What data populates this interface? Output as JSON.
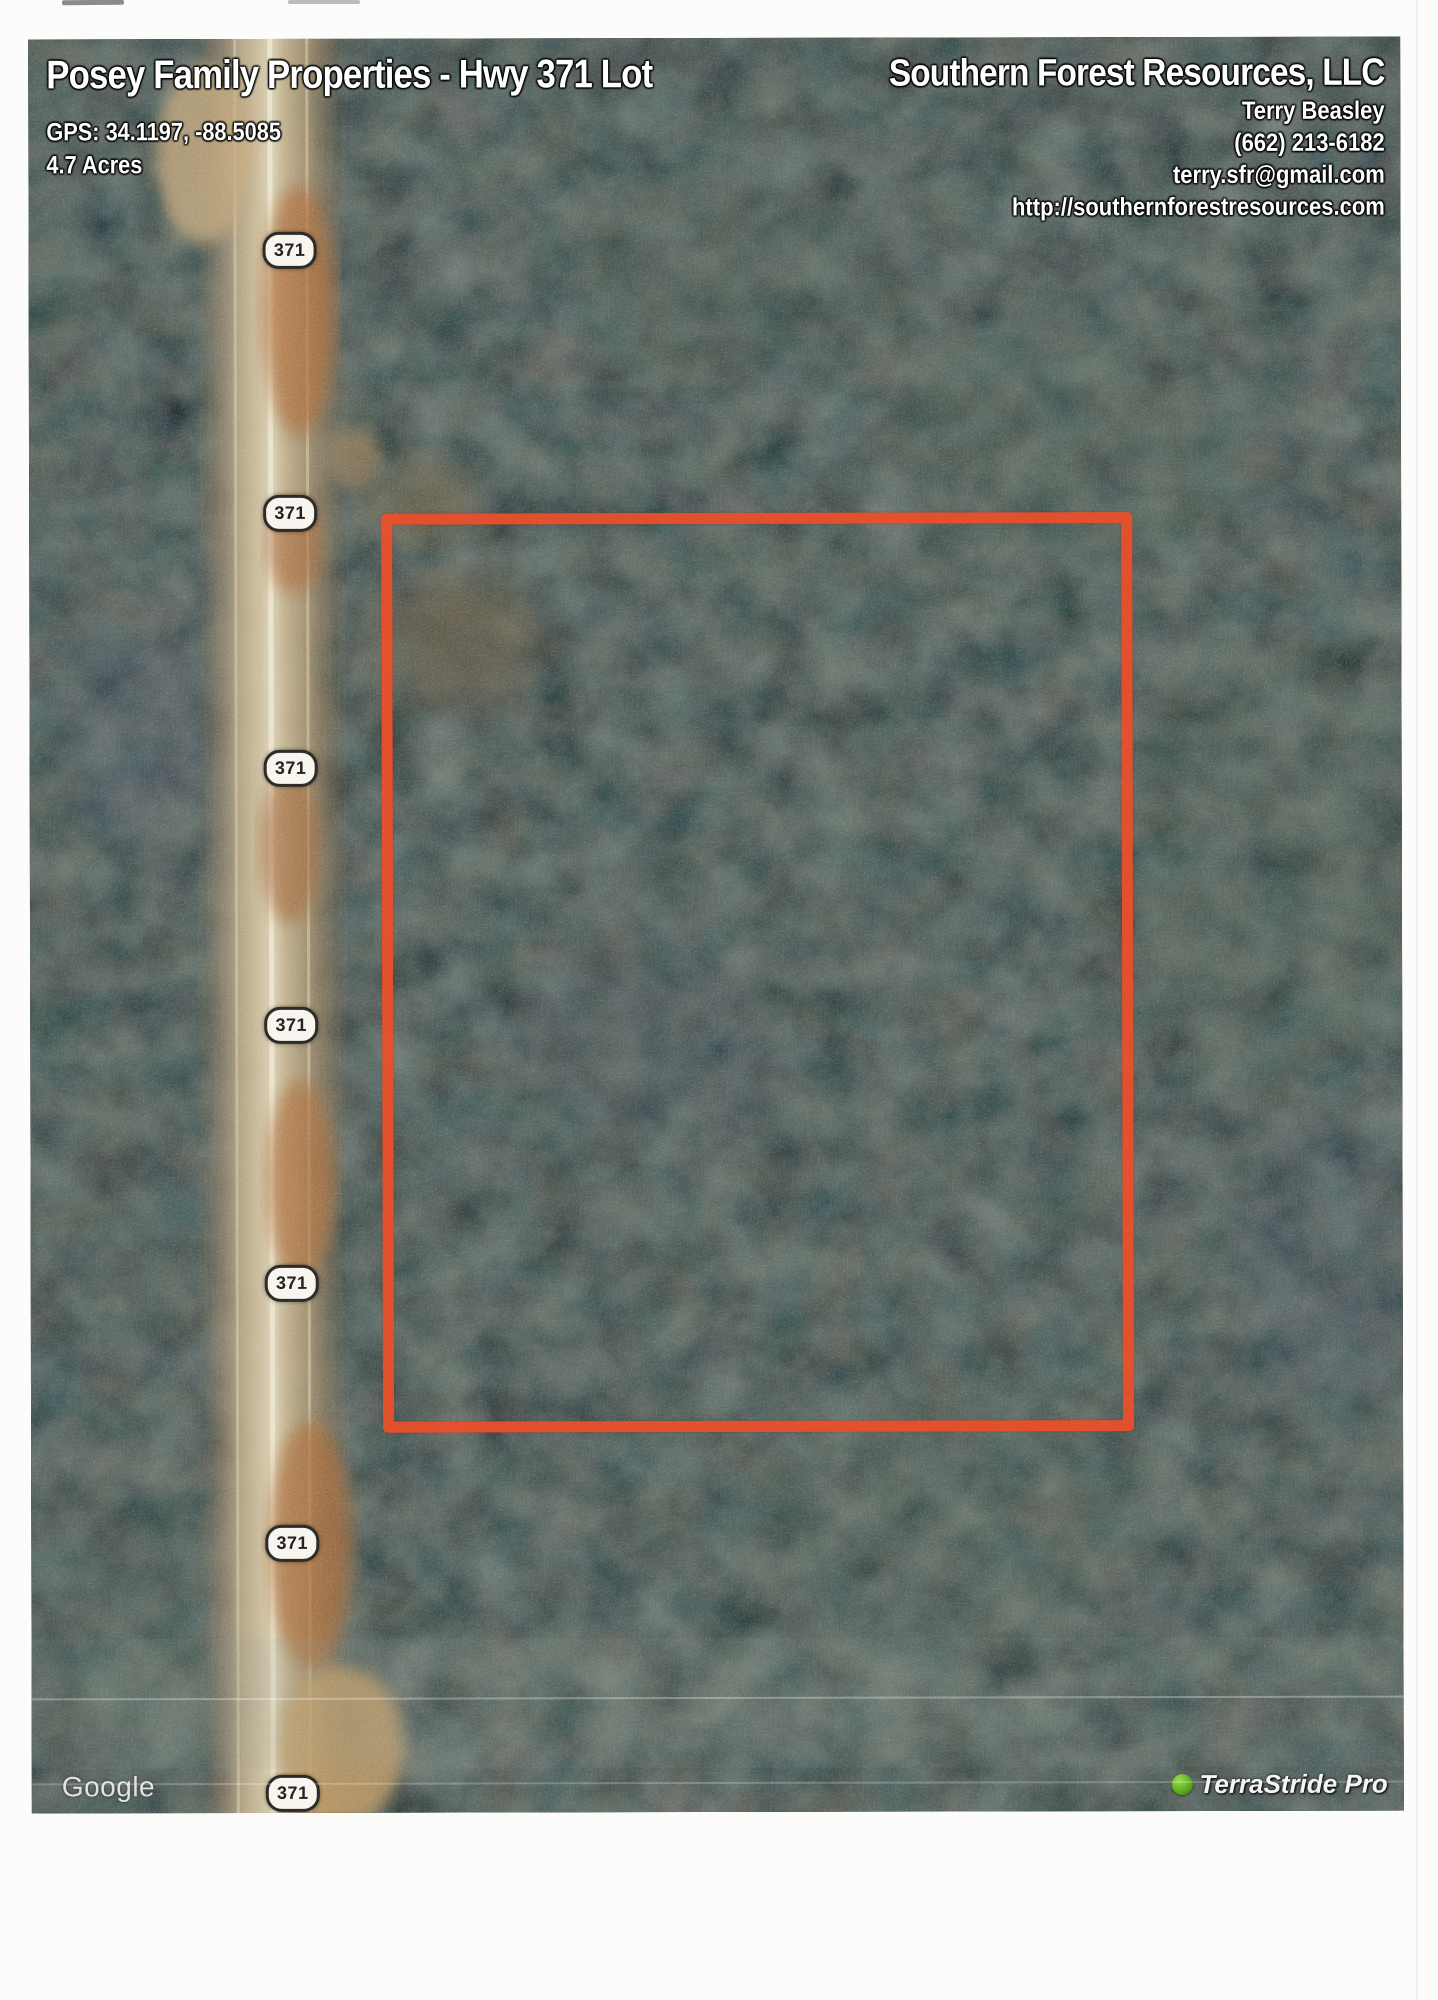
{
  "header_left": {
    "title": "Posey Family Properties - Hwy 371 Lot",
    "gps": "GPS: 34.1197, -88.5085",
    "acreage": "4.7 Acres"
  },
  "header_right": {
    "company": "Southern Forest Resources, LLC",
    "agent": "Terry Beasley",
    "phone": "(662) 213-6182",
    "email": "terry.sfr@gmail.com",
    "website": "http://southernforestresources.com"
  },
  "map": {
    "route_shield": "371",
    "google_watermark": "Google",
    "terrastride_watermark": "TerraStride Pro",
    "boundary_color": "#e8502c"
  }
}
